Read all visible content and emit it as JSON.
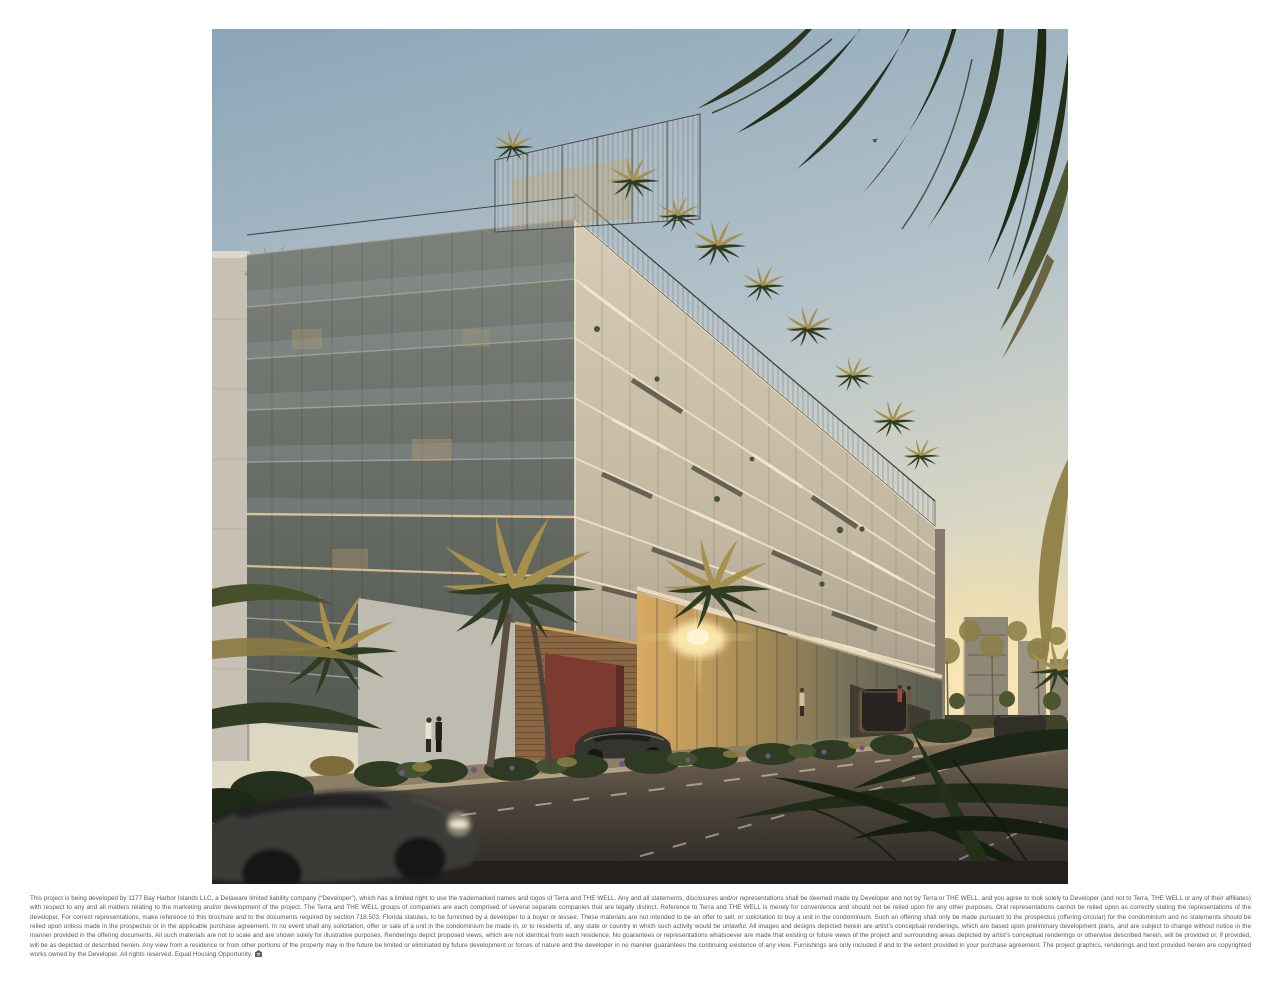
{
  "page": {
    "background": "#ffffff",
    "kind": "condominium marketing brochure page"
  },
  "artwork": {
    "type": "architectural rendering",
    "description": "Dusk street-level view of a modern mid-rise condominium with stacked glass balconies and a rooftop mesh screen, framed by palm trees; golden sunset light reflects in the ground-floor glass, a motion-blurred car passes on the street, pedestrians walk along the landscaped sidewalk, and dark palm fronds hang across the upper right corner of the square image.",
    "elements": [
      "mid-rise condominium building with cantilevered glass balconies",
      "rooftop perforated mesh screen and rooftop palms",
      "adjacent cream building at left edge",
      "ground-floor glass with sunset reflection and sun flare",
      "wood-slat wall and dark red garage door",
      "parked sports car and parked van",
      "pedestrians on sidewalk",
      "motion-blurred passing car in foreground",
      "street with dashed lane markings receding to a golden vanishing point",
      "palm trees and tropical landscaping",
      "dark palm fronds silhouetted in top-right corner",
      "small bird in the sky"
    ]
  },
  "disclaimer": {
    "text": "This project is being developed by 1177 Bay Harbor Islands LLC, a Delaware limited liability company (“Developer”), which has a limited right to use the trademarked names and logos of Terra and THE WELL.  Any and all statements, disclosures and/or representations shall be deemed made by Developer and not by Terra or THE WELL, and you agree to look solely to Developer (and not to Terra, THE WELL or any of their affiliates) with respect to any and all matters relating to the marketing and/or development of the project. The Terra and THE WELL groups of companies are each comprised of several separate companies that are legally distinct. Reference to Terra and THE WELL is merely for convenience and should not be relied upon for any other purposes. Oral representations cannot be relied upon as correctly stating the representations of the developer. For correct representations, make reference to this brochure and to the documents required by section 718.503, Florida statutes, to be furnished by a developer to a buyer or lessee. These materials are not intended to be an offer to sell, or solicitation to buy a unit in the condominium. Such an offering shall only be made pursuant to the prospectus (offering circular) for the condominium and no statements should be relied upon unless made in the prospectus or in the applicable purchase agreement. In no event shall any solicitation, offer or sale of a unit in the condominium be made in, or to residents of, any state or country in which such activity would be unlawful. All images and designs depicted herein are artist’s conceptual renderings, which are based upon preliminary development plans, and are subject to change without notice in the manner provided in the offering documents. All such materials are not to scale and are shown solely for illustrative purposes.  Renderings depict proposed views, which are not identical from each residence.  No guarantees or representations whatsoever are made that existing or future views of the project and surrounding areas depicted by artist’s conceptual renderings or otherwise described herein, will be provided or, if provided, will be as depicted or described herein.  Any view from a residence or from other portions of the property may in the future be limited or eliminated by future development or forces of nature and the developer in no manner guarantees the continuing existence of any view.  Furnishings are only included if and to the extent provided in your purchase agreement. The project graphics, renderings and text provided herein are copyrighted works owned by the Developer. All rights reserved. Equal Housing Opportunity.",
    "equal_housing_icon": "equal-housing-opportunity"
  },
  "colors": {
    "page-bg": "#ffffff",
    "ink": "#56585a",
    "sky-top": "#8ba5b7",
    "sky-mid": "#c0cbd0",
    "horizon-glow": "#f3e3b2",
    "facade-cream": "#d3c8b2",
    "facade-shadow": "#5d635c",
    "glass-gold": "#d8ab63",
    "garage-red": "#7c3a31",
    "wood": "#8a6743",
    "street-dark": "#2b2825",
    "palm-dark": "#243018",
    "palm-lit": "#a6904c"
  }
}
